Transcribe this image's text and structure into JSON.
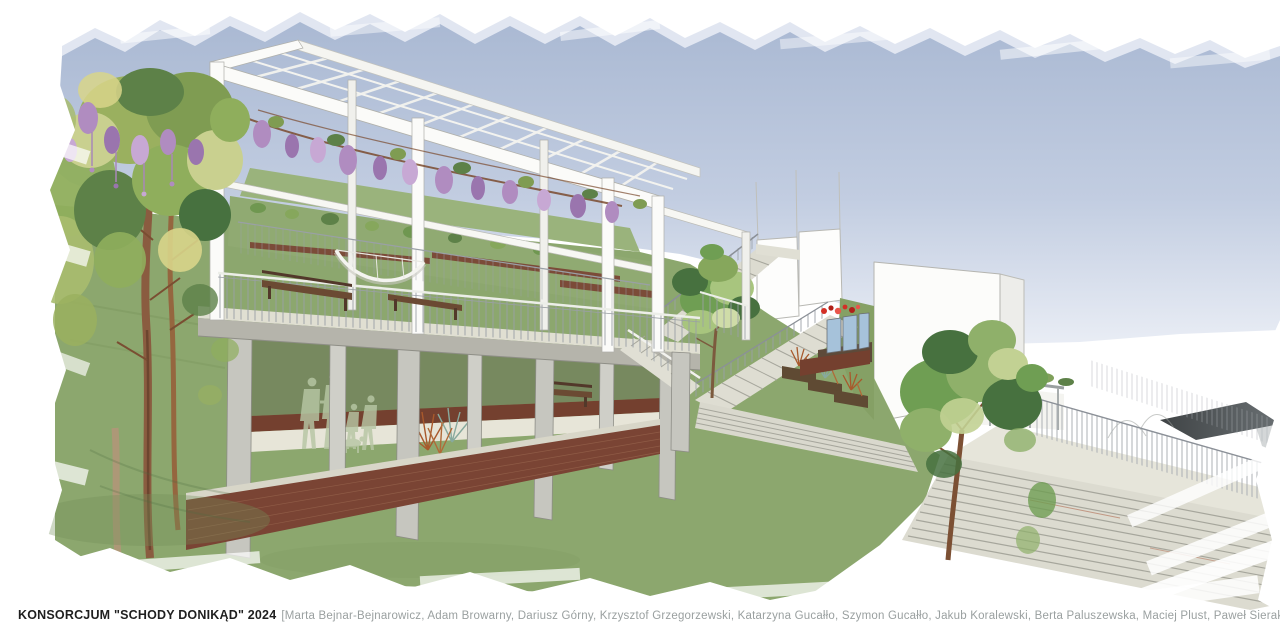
{
  "caption": {
    "title": "KONSORCJUM \"SCHODY DONIKĄD\" 2024",
    "credits": "[Marta Bejnar-Bejnarowicz, Adam Browarny, Dariusz Górny, Krzysztof Grzegorzewski, Katarzyna Gucałło, Szymon Gucałło, Jakub Koralewski, Berta Paluszewska, Maciej Plust, Paweł Sierakowski, Joanna Styka – Lebioda, Agnieszka Wasielewska-Prychoda, Marcin Żurowski]"
  },
  "palette": {
    "sky_top": "#a9b8d3",
    "sky_bottom": "#dde4f0",
    "grass": "#8ca76e",
    "grass_dark": "#7a945c",
    "grass_light": "#9cb37e",
    "concrete_top": "#e0dfd2",
    "concrete_face": "#b5b4ab",
    "step": "#dcdbd0",
    "brick": "#7a4434",
    "brick_dark": "#5f3226",
    "wood": "#6b4a33",
    "trunk": "#8a5c40",
    "wisteria": "#b08cc0",
    "leaf": "#7f9c52",
    "leaf_light": "#c9d08f",
    "leaf_dark": "#47713f",
    "white_structure": "#fbfbf9",
    "roof_dark": "#4c5052",
    "glass_blue": "#a6c2da",
    "flower_red": "#d32f25",
    "figure": "#b7c6a4",
    "rust_grass": "#a8592c",
    "teal_grass": "#87a99e",
    "railing_gray": "#8b9097"
  }
}
